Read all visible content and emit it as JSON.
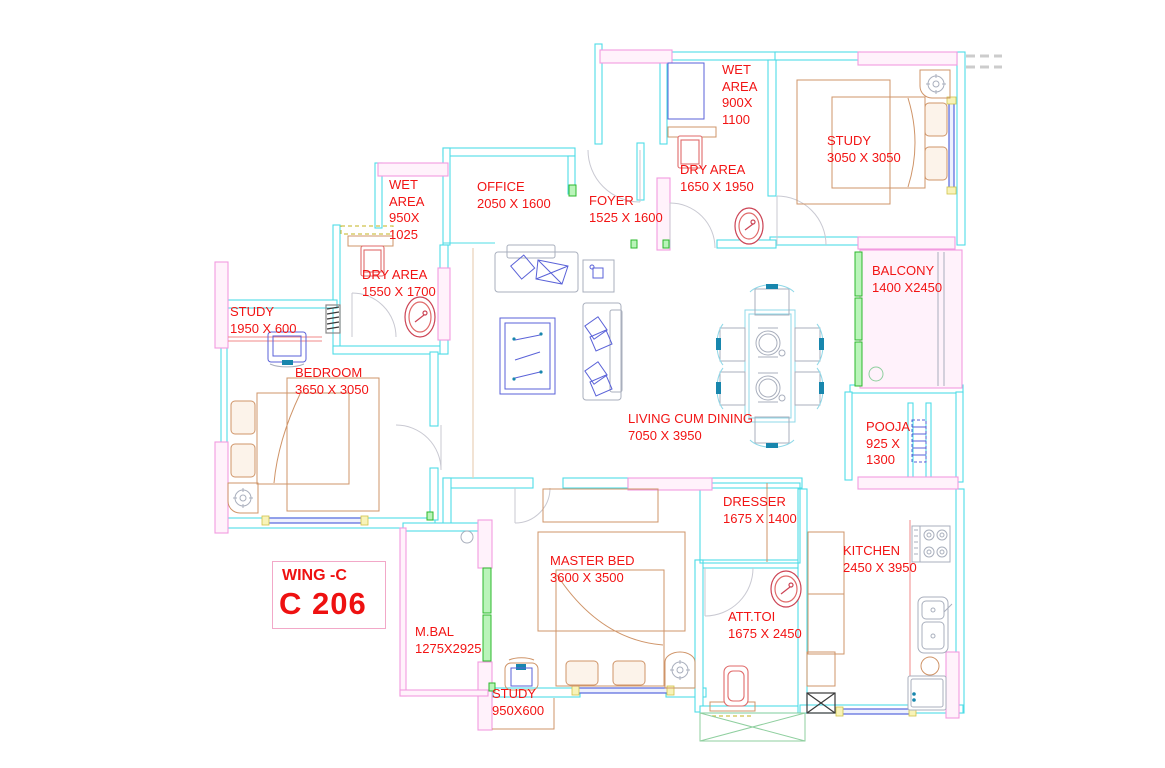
{
  "plan": {
    "unit_box": {
      "wing": "WING -C",
      "unit": "C 206"
    },
    "rooms": [
      {
        "id": "wet-area-top",
        "label": "WET\nAREA\n900X\n1100"
      },
      {
        "id": "dry-area-right",
        "label": "DRY AREA\n1650 X 1950"
      },
      {
        "id": "study-top-right",
        "label": "STUDY\n3050 X 3050"
      },
      {
        "id": "balcony",
        "label": "BALCONY\n1400 X2450"
      },
      {
        "id": "pooja",
        "label": "POOJA\n925 X\n1300"
      },
      {
        "id": "kitchen",
        "label": "KITCHEN\n2450 X 3950"
      },
      {
        "id": "dresser",
        "label": "DRESSER\n1675 X 1400"
      },
      {
        "id": "att-toi",
        "label": "ATT.TOI\n1675 X 2450"
      },
      {
        "id": "master-bed",
        "label": "MASTER BED\n3600 X 3500"
      },
      {
        "id": "study-bottom",
        "label": "STUDY\n950X600"
      },
      {
        "id": "m-bal",
        "label": "M.BAL\n1275X2925"
      },
      {
        "id": "bedroom",
        "label": "BEDROOM\n3650 X 3050"
      },
      {
        "id": "study-left",
        "label": "STUDY\n1950 X 600"
      },
      {
        "id": "dry-area-left",
        "label": "DRY AREA\n1550 X 1700"
      },
      {
        "id": "wet-area-left",
        "label": "WET\nAREA\n950X\n1025"
      },
      {
        "id": "office",
        "label": "OFFICE\n2050 X 1600"
      },
      {
        "id": "foyer",
        "label": "FOYER\n1525 X 1600"
      },
      {
        "id": "living",
        "label": "LIVING CUM DINING\n7050 X 3950"
      }
    ],
    "colors": {
      "wall_cyan": "#4fdce6",
      "wall_pink": "#f29ae0",
      "window_green": "#2cb82c",
      "label_red": "#f21414",
      "furniture_tan": "#cf9468",
      "furniture_blue": "#5a62d8"
    }
  }
}
